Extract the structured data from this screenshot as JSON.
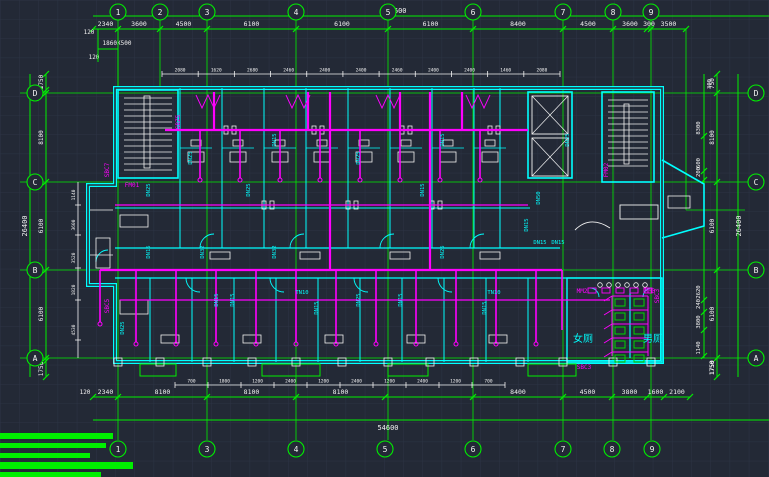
{
  "drawing": {
    "kind": "cad-plumbing-floor-plan",
    "overall_width": "54600",
    "overall_height": "26400"
  },
  "grid": {
    "top_bubbles": [
      "1",
      "2",
      "3",
      "4",
      "5",
      "6",
      "7",
      "8",
      "9"
    ],
    "bottom_bubbles": [
      "1",
      "3",
      "4",
      "5",
      "6",
      "7",
      "8",
      "9"
    ],
    "left_bubbles": [
      "D",
      "C",
      "B",
      "A"
    ],
    "right_bubbles": [
      "D",
      "C",
      "B",
      "A"
    ]
  },
  "dimensions": {
    "top_chain": [
      "2340",
      "3600",
      "4500",
      "6100",
      "6100",
      "6100",
      "8400",
      "4500",
      "3600",
      "300",
      "3500"
    ],
    "top_overall": "54600",
    "top_extra": [
      "120",
      "1860X500",
      "120"
    ],
    "bottom_chain": [
      "2340",
      "8100",
      "8100",
      "8100",
      "",
      "8400",
      "4500",
      "3800",
      "1600",
      "2100"
    ],
    "bottom_extra": "120",
    "bottom_overall": "54600",
    "left_chain": [
      "1750",
      "300",
      "8100",
      "6100",
      "6100",
      "300",
      "1750"
    ],
    "left_overall": "26400",
    "right_grid_chain": [
      "750",
      "8100",
      "6100",
      "6100",
      "1750"
    ],
    "right_top_small": "300",
    "right_inner_chain": [
      "8300",
      "600",
      "200",
      "2620",
      "240",
      "3800",
      "1140"
    ],
    "right_overall": "26400",
    "top_small": [
      "2080",
      "1620",
      "2680",
      "2460",
      "2400",
      "2400",
      "2460",
      "2400",
      "2400",
      "1460",
      "2080"
    ],
    "bottom_small": [
      "700",
      "1800",
      "1200",
      "2400",
      "1200",
      "2400",
      "1200",
      "2400",
      "1200",
      "700"
    ],
    "left_inner_small": [
      "1140",
      "3600",
      "3520",
      "1820",
      "4530"
    ]
  },
  "rooms": {
    "womens_toilet": "女厕",
    "mens_toilet": "男厕"
  },
  "labels": {
    "pipe_labels": [
      "DN15",
      "DN25",
      "DN32",
      "DN40",
      "DN50",
      "TN10"
    ],
    "riser_labels": [
      "SBC7",
      "SBZ5",
      "SBC5",
      "SBC3"
    ],
    "door_labels": [
      "FM01",
      "FM02",
      "MM2",
      "MM3"
    ]
  },
  "colors": {
    "background": "#232936",
    "grid_faint": "#2c3444",
    "green": "#00ef00",
    "cyan": "#00ffff",
    "magenta": "#ff00ff",
    "white": "#f2f2f2",
    "fixture_green": "#00d400"
  }
}
